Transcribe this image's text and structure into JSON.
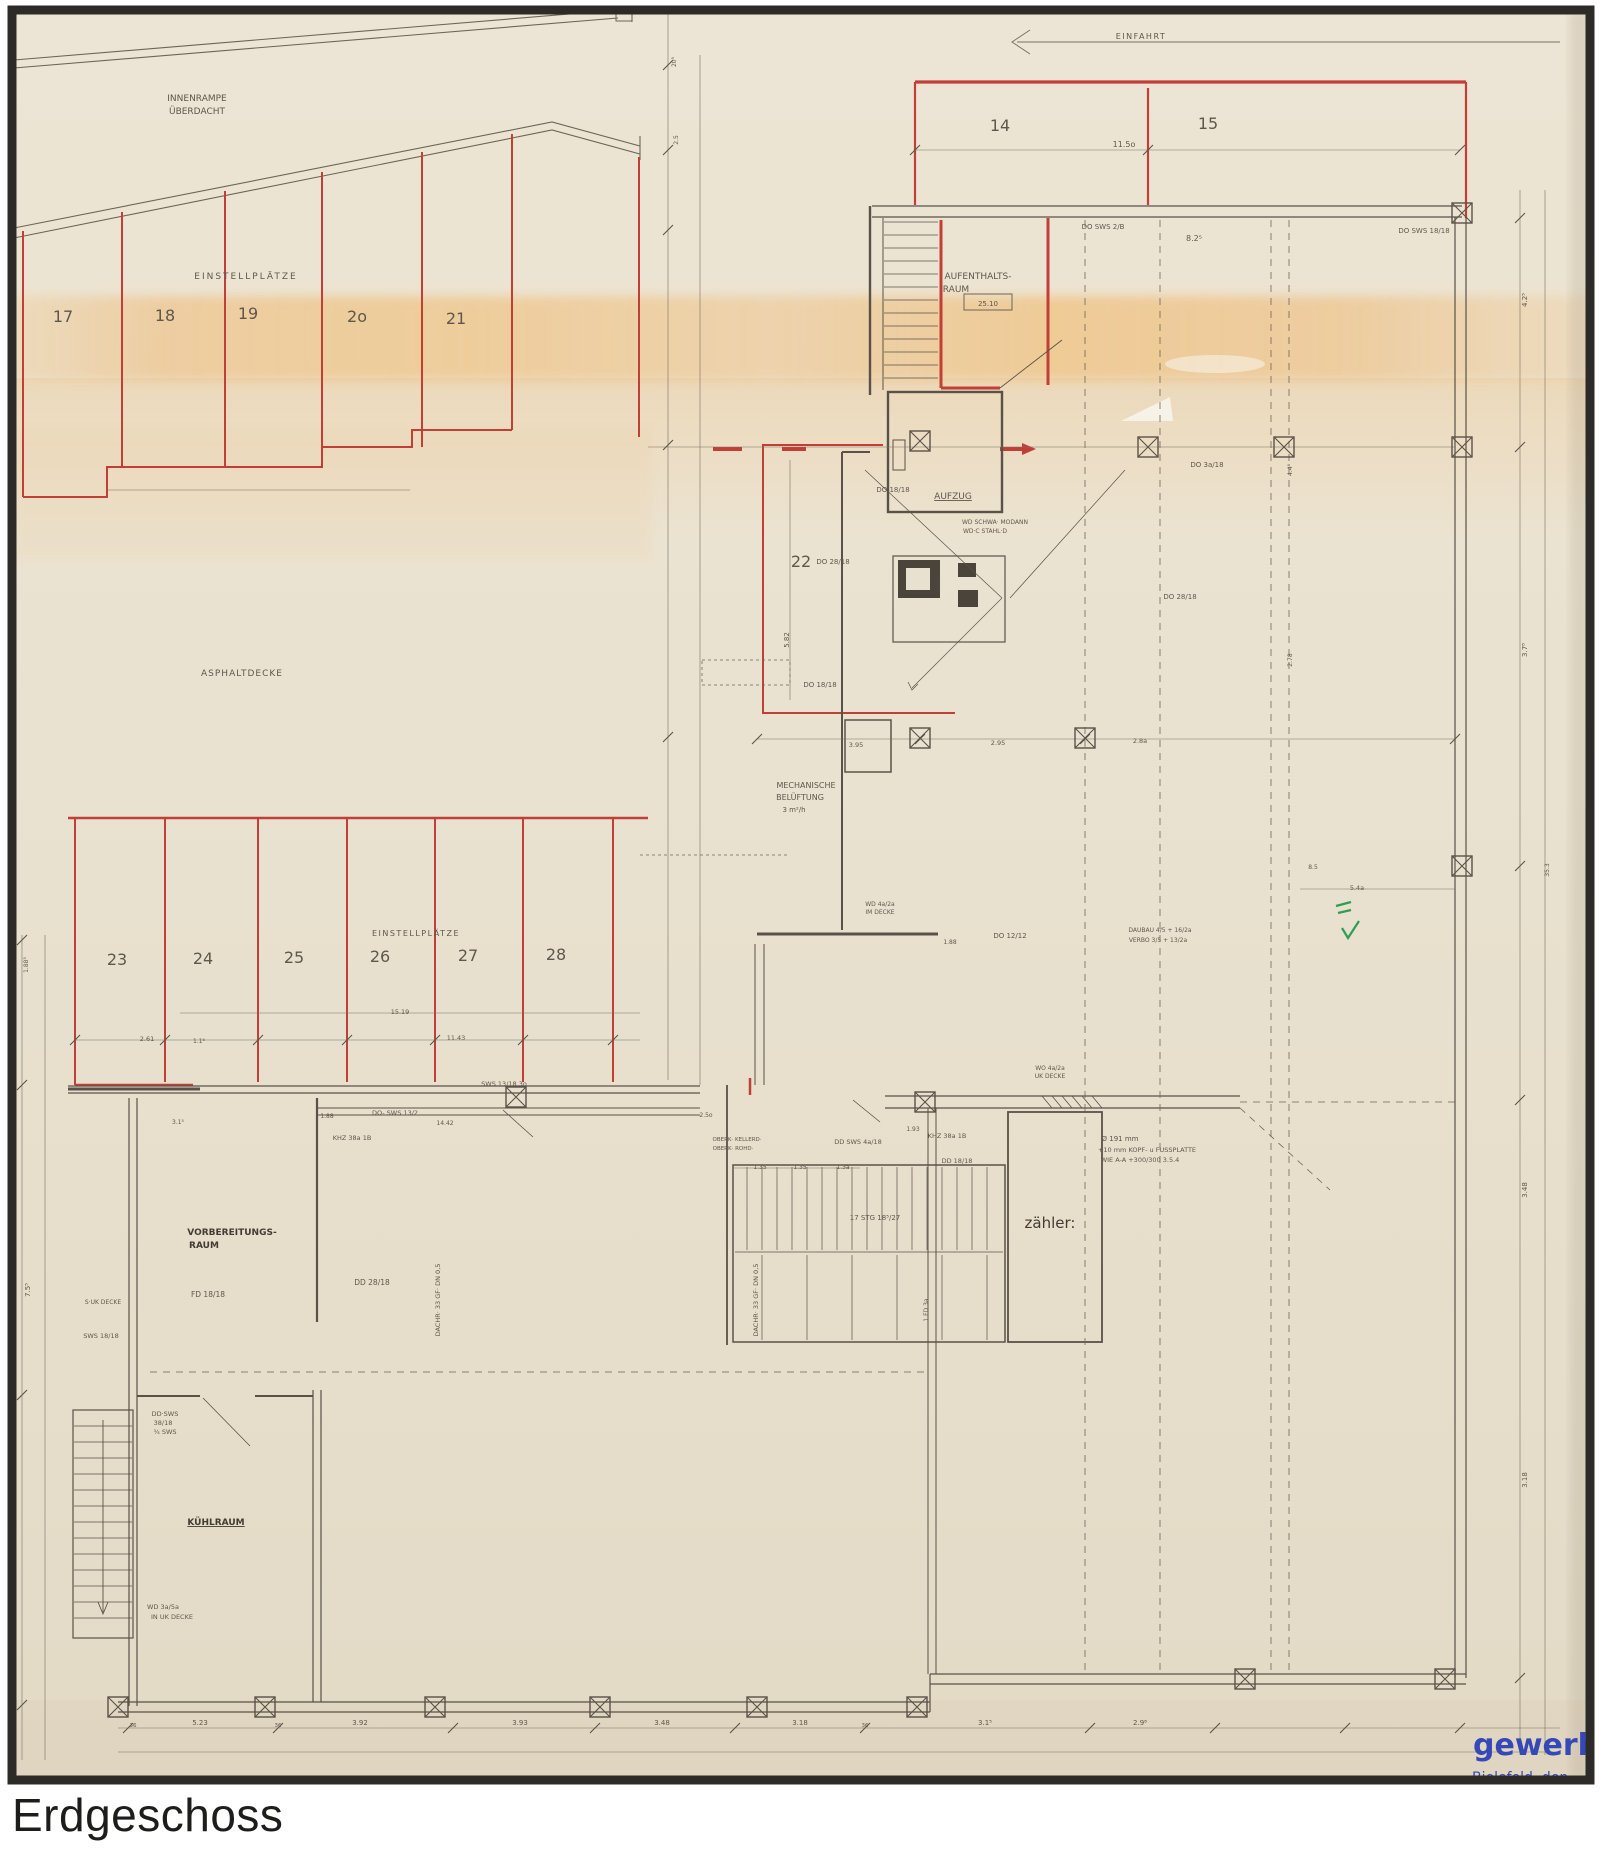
{
  "page": {
    "title": "Erdgeschoss"
  },
  "plan": {
    "colors": {
      "ink": "#5f574b",
      "dark": "#423c33",
      "red": "#c23f38",
      "blue": "#3448b8",
      "green": "#2f9e53"
    },
    "stamp": {
      "company": "gewerbebau",
      "city_line": "Bielefeld, den"
    },
    "areas": {
      "ramp": "INNENRAMPE ÜBERDACHT",
      "parking_upper": "EINSTELLPLÄTZE",
      "yard": "ASPHALTDECKE",
      "parking_lower": "EINSTELLPLÄTZE",
      "entry": "EINFAHRT",
      "lounge": "AUFENTHALTS-RAUM",
      "elevator": "AUFZUG",
      "ventilation": "MECHANISCHE BELÜFTUNG",
      "prep_room": "VORBEREITUNGS-RAUM",
      "cold_room": "KÜHLRAUM",
      "meter_room": "zähler:"
    },
    "parking_spaces": {
      "upper_left": [
        "17",
        "18",
        "19",
        "2o",
        "21"
      ],
      "upper_right": [
        "14",
        "15"
      ],
      "middle": [
        "22"
      ],
      "lower": [
        "23",
        "24",
        "25",
        "26",
        "27",
        "28"
      ]
    },
    "annotations": [
      {
        "n": "label-innenrampe-1",
        "t": "INNENRAMPE",
        "x": 197,
        "y": 101,
        "s": 9
      },
      {
        "n": "label-innenrampe-2",
        "t": "ÜBERDACHT",
        "x": 197,
        "y": 114,
        "s": 9
      },
      {
        "n": "label-einstellplaetze-upper",
        "t": "EINSTELLPLÄTZE",
        "x": 246,
        "y": 279,
        "s": 9,
        "ls": 2
      },
      {
        "n": "space-17",
        "t": "17",
        "x": 63,
        "y": 322,
        "s": 16
      },
      {
        "n": "space-18",
        "t": "18",
        "x": 165,
        "y": 321,
        "s": 16
      },
      {
        "n": "space-19",
        "t": "19",
        "x": 248,
        "y": 319,
        "s": 16
      },
      {
        "n": "space-20",
        "t": "2o",
        "x": 357,
        "y": 322,
        "s": 16
      },
      {
        "n": "space-21",
        "t": "21",
        "x": 456,
        "y": 324,
        "s": 16
      },
      {
        "n": "label-einfahrt",
        "t": "EINFAHRT",
        "x": 1141,
        "y": 39,
        "s": 8,
        "ls": 1.5
      },
      {
        "n": "space-14",
        "t": "14",
        "x": 1000,
        "y": 131,
        "s": 16
      },
      {
        "n": "space-15",
        "t": "15",
        "x": 1208,
        "y": 129,
        "s": 16
      },
      {
        "n": "dim-11-5",
        "t": "11.5o",
        "x": 1124,
        "y": 147,
        "s": 8
      },
      {
        "n": "label-aufenthaltsraum-1",
        "t": "AUFENTHALTS-",
        "x": 978,
        "y": 279,
        "s": 9
      },
      {
        "n": "label-aufenthaltsraum-2",
        "t": "RAUM",
        "x": 956,
        "y": 292,
        "s": 9
      },
      {
        "n": "room-size-box",
        "t": "25.10",
        "x": 988,
        "y": 306,
        "s": 7
      },
      {
        "n": "dim-do-sws-2b",
        "t": "DO SWS 2/B",
        "x": 1103,
        "y": 229,
        "s": 7
      },
      {
        "n": "dim-do-sws-1818",
        "t": "DO SWS 18/18",
        "x": 1424,
        "y": 233,
        "s": 7
      },
      {
        "n": "dim-8-25",
        "t": "8.2⁵",
        "x": 1194,
        "y": 241,
        "s": 8
      },
      {
        "n": "label-aufzug",
        "t": "AUFZUG",
        "x": 953,
        "y": 499,
        "s": 9,
        "u": 1
      },
      {
        "n": "space-22",
        "t": "22",
        "x": 801,
        "y": 567,
        "s": 16
      },
      {
        "n": "dim-5-82",
        "t": "5.82",
        "x": 789,
        "y": 640,
        "s": 7,
        "r": -90
      },
      {
        "n": "label-asphaltdecke",
        "t": "ASPHALTDECKE",
        "x": 242,
        "y": 676,
        "s": 9,
        "ls": 1
      },
      {
        "n": "dim-do-1818-a",
        "t": "DO 18/18",
        "x": 893,
        "y": 492,
        "s": 7
      },
      {
        "n": "dim-wd-schwa",
        "t": "WD SCHWA· MODANN",
        "x": 995,
        "y": 524,
        "s": 6
      },
      {
        "n": "dim-wd-stahl",
        "t": "WD·C STAHL·D",
        "x": 985,
        "y": 533,
        "s": 6
      },
      {
        "n": "dim-do-2818-a",
        "t": "DO 28/18",
        "x": 833,
        "y": 564,
        "s": 7
      },
      {
        "n": "dim-do-3a18",
        "t": "DO 3a/18",
        "x": 1207,
        "y": 467,
        "s": 7
      },
      {
        "n": "dim-do-2818-b",
        "t": "DO 28/18",
        "x": 1180,
        "y": 599,
        "s": 7
      },
      {
        "n": "dim-do-1818-b",
        "t": "DO 18/18",
        "x": 820,
        "y": 687,
        "s": 7
      },
      {
        "n": "label-mech-1",
        "t": "MECHANISCHE",
        "x": 806,
        "y": 788,
        "s": 8
      },
      {
        "n": "label-mech-2",
        "t": "BELÜFTUNG",
        "x": 800,
        "y": 800,
        "s": 8
      },
      {
        "n": "label-mech-3",
        "t": "3 m²/h",
        "x": 794,
        "y": 812,
        "s": 7
      },
      {
        "n": "dim-3-95",
        "t": "3.95",
        "x": 856,
        "y": 747,
        "s": 6.5
      },
      {
        "n": "dim-2-95",
        "t": "2.95",
        "x": 998,
        "y": 745,
        "s": 6.5
      },
      {
        "n": "dim-2-8a",
        "t": "2.8a",
        "x": 1140,
        "y": 743,
        "s": 6.5
      },
      {
        "n": "dim-do-1212",
        "t": "DO 12/12",
        "x": 1010,
        "y": 938,
        "s": 7
      },
      {
        "n": "dim-1-88-a",
        "t": "1.88",
        "x": 950,
        "y": 944,
        "s": 6
      },
      {
        "n": "dim-wd-4a2a-1",
        "t": "WD 4a/2a",
        "x": 880,
        "y": 906,
        "s": 6
      },
      {
        "n": "dim-wd-4a2a-2",
        "t": "IM DECKE",
        "x": 880,
        "y": 914,
        "s": 6
      },
      {
        "n": "label-einstellplaetze-lower",
        "t": "EINSTELLPLÄTZE",
        "x": 416,
        "y": 936,
        "s": 8,
        "ls": 1.5
      },
      {
        "n": "space-23",
        "t": "23",
        "x": 117,
        "y": 965,
        "s": 16
      },
      {
        "n": "space-24",
        "t": "24",
        "x": 203,
        "y": 964,
        "s": 16
      },
      {
        "n": "space-25",
        "t": "25",
        "x": 294,
        "y": 963,
        "s": 16
      },
      {
        "n": "space-26",
        "t": "26",
        "x": 380,
        "y": 962,
        "s": 16
      },
      {
        "n": "space-27",
        "t": "27",
        "x": 468,
        "y": 961,
        "s": 16
      },
      {
        "n": "space-28",
        "t": "28",
        "x": 556,
        "y": 960,
        "s": 16
      },
      {
        "n": "dim-15-19",
        "t": "15.19",
        "x": 400,
        "y": 1014,
        "s": 6.5
      },
      {
        "n": "dim-2-61",
        "t": "2.61",
        "x": 147,
        "y": 1041,
        "s": 6.5
      },
      {
        "n": "dim-1-16",
        "t": "1.1⁶",
        "x": 199,
        "y": 1043,
        "s": 6
      },
      {
        "n": "dim-11-43",
        "t": "11.43",
        "x": 456,
        "y": 1040,
        "s": 6.5
      },
      {
        "n": "dim-sws-1318",
        "t": "SWS 13/18 3o",
        "x": 504,
        "y": 1086,
        "s": 6.5
      },
      {
        "n": "dim-do-sws-132",
        "t": "DO- SWS 13/2",
        "x": 395,
        "y": 1115,
        "s": 6.5
      },
      {
        "n": "dim-1-88-b",
        "t": "1.88",
        "x": 327,
        "y": 1118,
        "s": 6
      },
      {
        "n": "dim-14-42",
        "t": "14.42",
        "x": 445,
        "y": 1125,
        "s": 6
      },
      {
        "n": "dim-3-15",
        "t": "3.1⁵",
        "x": 178,
        "y": 1124,
        "s": 6
      },
      {
        "n": "dim-2-5o",
        "t": "2.5o",
        "x": 706,
        "y": 1117,
        "s": 6
      },
      {
        "n": "dim-1-93",
        "t": "1.93",
        "x": 913,
        "y": 1131,
        "s": 6
      },
      {
        "n": "dim-oberk-1",
        "t": "OBERK· KELLERD·",
        "x": 737,
        "y": 1141,
        "s": 5.5
      },
      {
        "n": "dim-oberk-2",
        "t": "OBERK· ROHD·",
        "x": 733,
        "y": 1150,
        "s": 5.5
      },
      {
        "n": "dim-khz-a",
        "t": "KHZ 38a 1B",
        "x": 352,
        "y": 1140,
        "s": 6.5
      },
      {
        "n": "dim-dd-sws-4a18",
        "t": "DD SWS 4a/18",
        "x": 858,
        "y": 1144,
        "s": 6.5
      },
      {
        "n": "dim-khz-b",
        "t": "KHZ 38a 1B",
        "x": 947,
        "y": 1138,
        "s": 6.5
      },
      {
        "n": "dim-dd-1818",
        "t": "DD 18/18",
        "x": 957,
        "y": 1163,
        "s": 6.5
      },
      {
        "n": "note-kopfplatte-1",
        "t": "Ø 191 mm",
        "x": 1120,
        "y": 1141,
        "s": 7
      },
      {
        "n": "note-kopfplatte-2",
        "t": "+10 mm KOPF- u FUSSPLATTE",
        "x": 1147,
        "y": 1152,
        "s": 6.5
      },
      {
        "n": "note-kopfplatte-3",
        "t": "WIE A-A +300/300  3.5.4",
        "x": 1140,
        "y": 1162,
        "s": 6.5
      },
      {
        "n": "dim-wo-4a2a-1",
        "t": "WO 4a/2a",
        "x": 1050,
        "y": 1070,
        "s": 6
      },
      {
        "n": "dim-wo-4a2a-2",
        "t": "UK DECKE",
        "x": 1050,
        "y": 1078,
        "s": 6
      },
      {
        "n": "dim-daubau",
        "t": "DAUBAU 4/5 + 16/2a",
        "x": 1160,
        "y": 932,
        "s": 6
      },
      {
        "n": "dim-verbo",
        "t": "VERBO 3/5 + 13/2a",
        "x": 1158,
        "y": 942,
        "s": 6
      },
      {
        "n": "label-zaehler",
        "t": "zähler:",
        "x": 1050,
        "y": 1228,
        "s": 15,
        "c": "dark",
        "w": 500
      },
      {
        "n": "dim-stairs",
        "t": "17 STG 18⁵/27",
        "x": 875,
        "y": 1220,
        "s": 7
      },
      {
        "n": "dim-1-35-a",
        "t": "1.35",
        "x": 760,
        "y": 1169,
        "s": 6
      },
      {
        "n": "dim-1-35-b",
        "t": "1.35",
        "x": 800,
        "y": 1169,
        "s": 6
      },
      {
        "n": "dim-1-3a",
        "t": "1.3a",
        "x": 843,
        "y": 1169,
        "s": 6
      },
      {
        "n": "label-vorbereitung-1",
        "t": "VORBEREITUNGS-",
        "x": 232,
        "y": 1235,
        "s": 9,
        "c": "dark",
        "w": 700
      },
      {
        "n": "label-vorbereitung-2",
        "t": "RAUM",
        "x": 204,
        "y": 1248,
        "s": 9,
        "c": "dark",
        "w": 700
      },
      {
        "n": "dim-fd-1818",
        "t": "FD 18/18",
        "x": 208,
        "y": 1297,
        "s": 7.5
      },
      {
        "n": "dim-dd-2818",
        "t": "DD 28/18",
        "x": 372,
        "y": 1285,
        "s": 7.5
      },
      {
        "n": "dim-s-uk-decke",
        "t": "S·UK DECKE",
        "x": 103,
        "y": 1304,
        "s": 6
      },
      {
        "n": "dim-sws-1818",
        "t": "SWS 18/18",
        "x": 101,
        "y": 1338,
        "s": 6.5
      },
      {
        "n": "dim-dd-sws-1",
        "t": "DD·SWS",
        "x": 165,
        "y": 1416,
        "s": 6.5
      },
      {
        "n": "dim-dd-sws-2",
        "t": "38/18",
        "x": 163,
        "y": 1425,
        "s": 6.5
      },
      {
        "n": "dim-dd-sws-3",
        "t": "¾ SWS",
        "x": 165,
        "y": 1434,
        "s": 6.5
      },
      {
        "n": "label-kuehlraum",
        "t": "KÜHLRAUM",
        "x": 216,
        "y": 1525,
        "s": 9,
        "c": "dark",
        "w": 700,
        "u": 1
      },
      {
        "n": "dim-wd-3a5a-1",
        "t": "WD 3a/5a",
        "x": 163,
        "y": 1609,
        "s": 6.5
      },
      {
        "n": "dim-wd-3a5a-2",
        "t": "IN UK DECKE",
        "x": 172,
        "y": 1619,
        "s": 6.5
      },
      {
        "n": "dim-dachr-1",
        "t": "DACHR· 33 GF· DN 0,5",
        "x": 440,
        "y": 1300,
        "s": 6.5,
        "r": -90
      },
      {
        "n": "dim-dachr-2",
        "t": "DACHR· 33 GF· DN 0,5",
        "x": 758,
        "y": 1300,
        "s": 6.5,
        "r": -90
      },
      {
        "n": "dim-1-fd-3a",
        "t": "1 FD 3a",
        "x": 928,
        "y": 1310,
        "s": 6,
        "r": -90
      },
      {
        "n": "dim-8-5",
        "t": "8.5",
        "x": 1313,
        "y": 869,
        "s": 6
      },
      {
        "n": "dim-5-4a",
        "t": "5.4a",
        "x": 1357,
        "y": 890,
        "s": 6.5
      },
      {
        "n": "dim-4-48",
        "t": "4.4⁸",
        "x": 1292,
        "y": 470,
        "s": 6,
        "r": -90
      },
      {
        "n": "dim-2-78",
        "t": "2.78",
        "x": 1292,
        "y": 660,
        "s": 6,
        "r": -90
      },
      {
        "n": "dim-4-25",
        "t": "4.2⁵",
        "x": 1527,
        "y": 300,
        "s": 7,
        "r": -90
      },
      {
        "n": "dim-3-78",
        "t": "3.7⁸",
        "x": 1527,
        "y": 650,
        "s": 7,
        "r": -90
      },
      {
        "n": "dim-35-3",
        "t": "35.3",
        "x": 1549,
        "y": 870,
        "s": 6,
        "r": -90
      },
      {
        "n": "dim-3-48-r",
        "t": "3.48",
        "x": 1527,
        "y": 1190,
        "s": 7,
        "r": -90
      },
      {
        "n": "dim-3-18-r",
        "t": "3.18",
        "x": 1527,
        "y": 1480,
        "s": 7,
        "r": -90
      },
      {
        "n": "dim-20-5",
        "t": "20⁵",
        "x": 676,
        "y": 62,
        "s": 6,
        "r": -90
      },
      {
        "n": "dim-2-5",
        "t": "2.5",
        "x": 678,
        "y": 140,
        "s": 6,
        "r": -90
      },
      {
        "n": "dim-7-55",
        "t": "7.5⁵",
        "x": 30,
        "y": 1290,
        "s": 7,
        "r": -90
      },
      {
        "n": "dim-1-885",
        "t": "1.88⁵",
        "x": 28,
        "y": 965,
        "s": 6,
        "r": -90
      },
      {
        "n": "dim-b-5-23",
        "t": "5.23",
        "x": 200,
        "y": 1725,
        "s": 7
      },
      {
        "n": "dim-b-3-92",
        "t": "3.92",
        "x": 360,
        "y": 1725,
        "s": 7
      },
      {
        "n": "dim-b-3-93",
        "t": "3.93",
        "x": 520,
        "y": 1725,
        "s": 7
      },
      {
        "n": "dim-b-3-48",
        "t": "3.48",
        "x": 662,
        "y": 1725,
        "s": 7
      },
      {
        "n": "dim-b-3-18",
        "t": "3.18",
        "x": 800,
        "y": 1725,
        "s": 7
      },
      {
        "n": "dim-b-3-15",
        "t": "3.1⁵",
        "x": 985,
        "y": 1725,
        "s": 7
      },
      {
        "n": "dim-b-2-98",
        "t": "2.9⁸",
        "x": 1140,
        "y": 1725,
        "s": 7
      },
      {
        "n": "dim-b-36-a",
        "t": "36",
        "x": 133,
        "y": 1727,
        "s": 5.5
      },
      {
        "n": "dim-b-36-b",
        "t": "36",
        "x": 278,
        "y": 1727,
        "s": 5.5
      },
      {
        "n": "dim-b-36-c",
        "t": "36",
        "x": 865,
        "y": 1727,
        "s": 5.5
      },
      {
        "n": "stamp-company",
        "t": "gewerbebau",
        "x": 1473,
        "y": 1755,
        "s": 30,
        "c": "blue",
        "w": 700,
        "a": "start"
      },
      {
        "n": "stamp-city",
        "t": "Bielefeld, den",
        "x": 1472,
        "y": 1782,
        "s": 14,
        "c": "blue",
        "w": 500,
        "a": "start"
      }
    ]
  }
}
